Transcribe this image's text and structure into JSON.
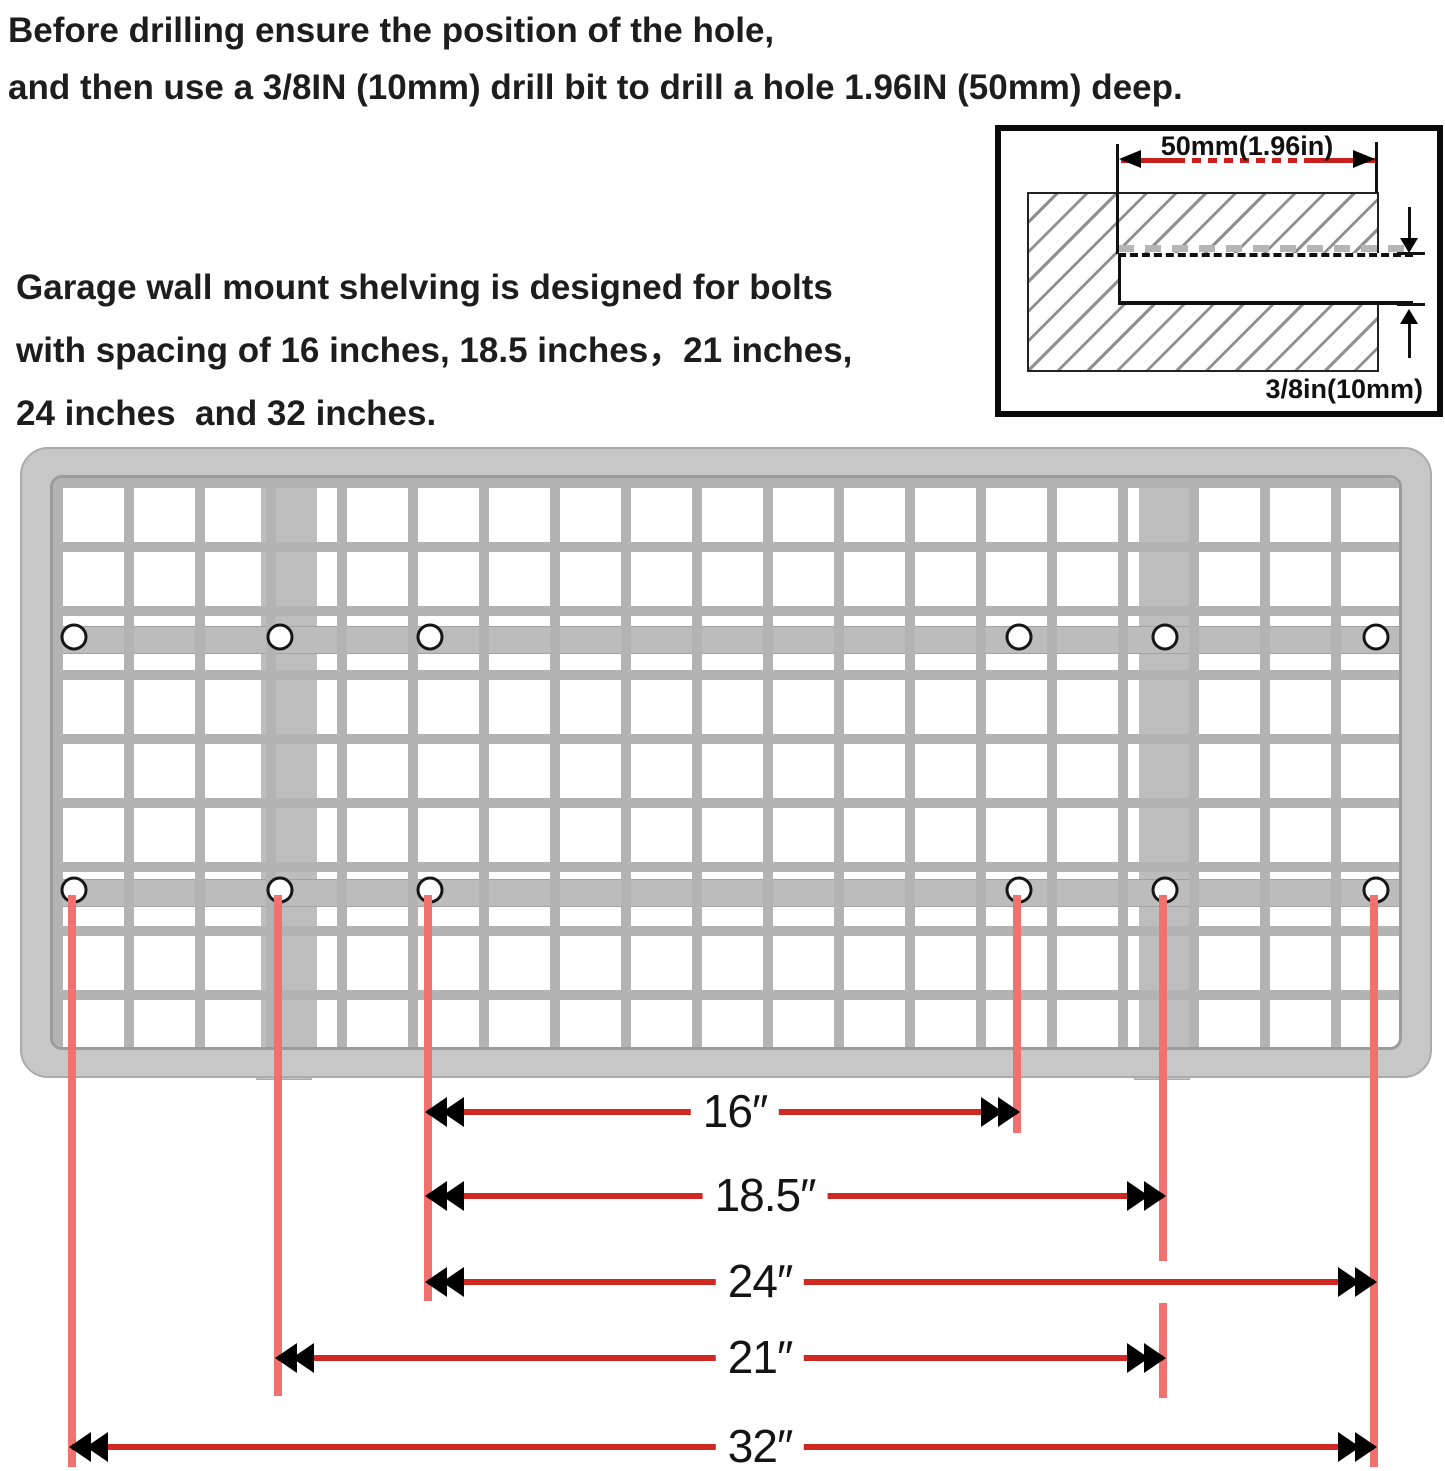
{
  "instructions": {
    "heading_line1": "Before drilling ensure the position of the hole,",
    "heading_line2": "and then use a 3/8IN (10mm) drill bit to drill a hole 1.96IN (50mm) deep.",
    "body_line1": "Garage wall mount shelving is designed for bolts",
    "body_line2": "with spacing of 16 inches, 18.5 inches，21 inches,",
    "body_line3": "24 inches  and 32 inches."
  },
  "drill_detail": {
    "depth_label": "50mm(1.96in)",
    "diameter_label": "3/8in(10mm)"
  },
  "measurements": {
    "unit": "inches",
    "spacings": [
      {
        "label": "16″",
        "value": 16
      },
      {
        "label": "18.5″",
        "value": 18.5
      },
      {
        "label": "24″",
        "value": 24
      },
      {
        "label": "21″",
        "value": 21
      },
      {
        "label": "32″",
        "value": 32
      }
    ]
  },
  "colors": {
    "dimension_line_red": "#d02823",
    "drop_line_salmon": "#f0716e",
    "inset_dim_red": "#c81e1c",
    "shelf_gray": "#c7c7c7",
    "text_black": "#1d1d1d"
  }
}
